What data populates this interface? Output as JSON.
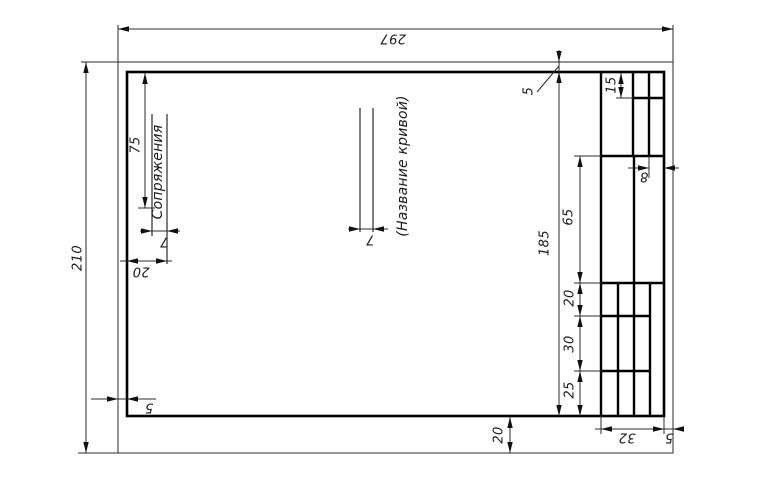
{
  "page": {
    "background": "#ffffff",
    "thin_line_color": "#2b2b2b",
    "thick_line_color": "#000000"
  },
  "dims": {
    "sheet_width": "297",
    "sheet_height": "210",
    "margin_left": "5",
    "margin_top": "5",
    "margin_right": "5",
    "margin_bottom": "20",
    "title_length": "75",
    "title_line_gap": "7",
    "title_offset": "20",
    "curve_line_gap": "7",
    "block_height": "185",
    "block_width": "32",
    "row_top": "15",
    "row_65": "65",
    "row_20": "20",
    "row_30": "30",
    "row_25": "25",
    "col_last": "8"
  },
  "labels": {
    "work_title": "Сопряжения",
    "curve_name": "(Название кривой)"
  }
}
